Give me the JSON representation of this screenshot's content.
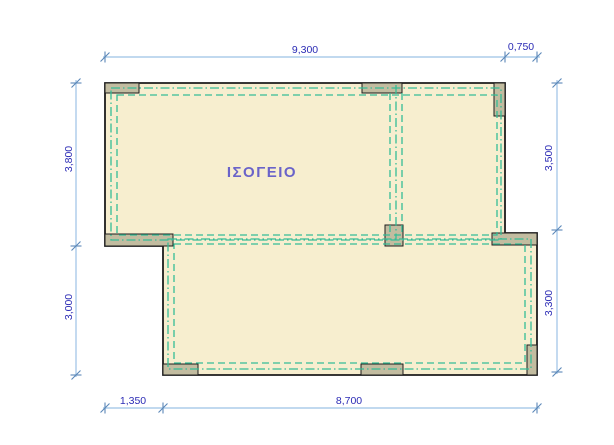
{
  "room": {
    "label": "ΙΣΟΓΕΙΟ"
  },
  "dimensions": {
    "top_width": "9,300",
    "top_right_offset": "0,750",
    "left_upper": "3,800",
    "left_lower": "3,000",
    "right_upper": "3,500",
    "right_lower": "3,300",
    "bottom_left_offset": "1,350",
    "bottom_width": "8,700"
  },
  "colors": {
    "background": "#FFFFFF",
    "floor_fill": "#F7EECF",
    "column_fill": "#C2BCA0",
    "outline": "#1C1C1C",
    "beam_dash": "#35BD96",
    "dim_line": "#9CC2E5",
    "dim_tick": "#5B87B8",
    "dim_text": "#2B2BB5",
    "room_label": "#6A63C9"
  }
}
